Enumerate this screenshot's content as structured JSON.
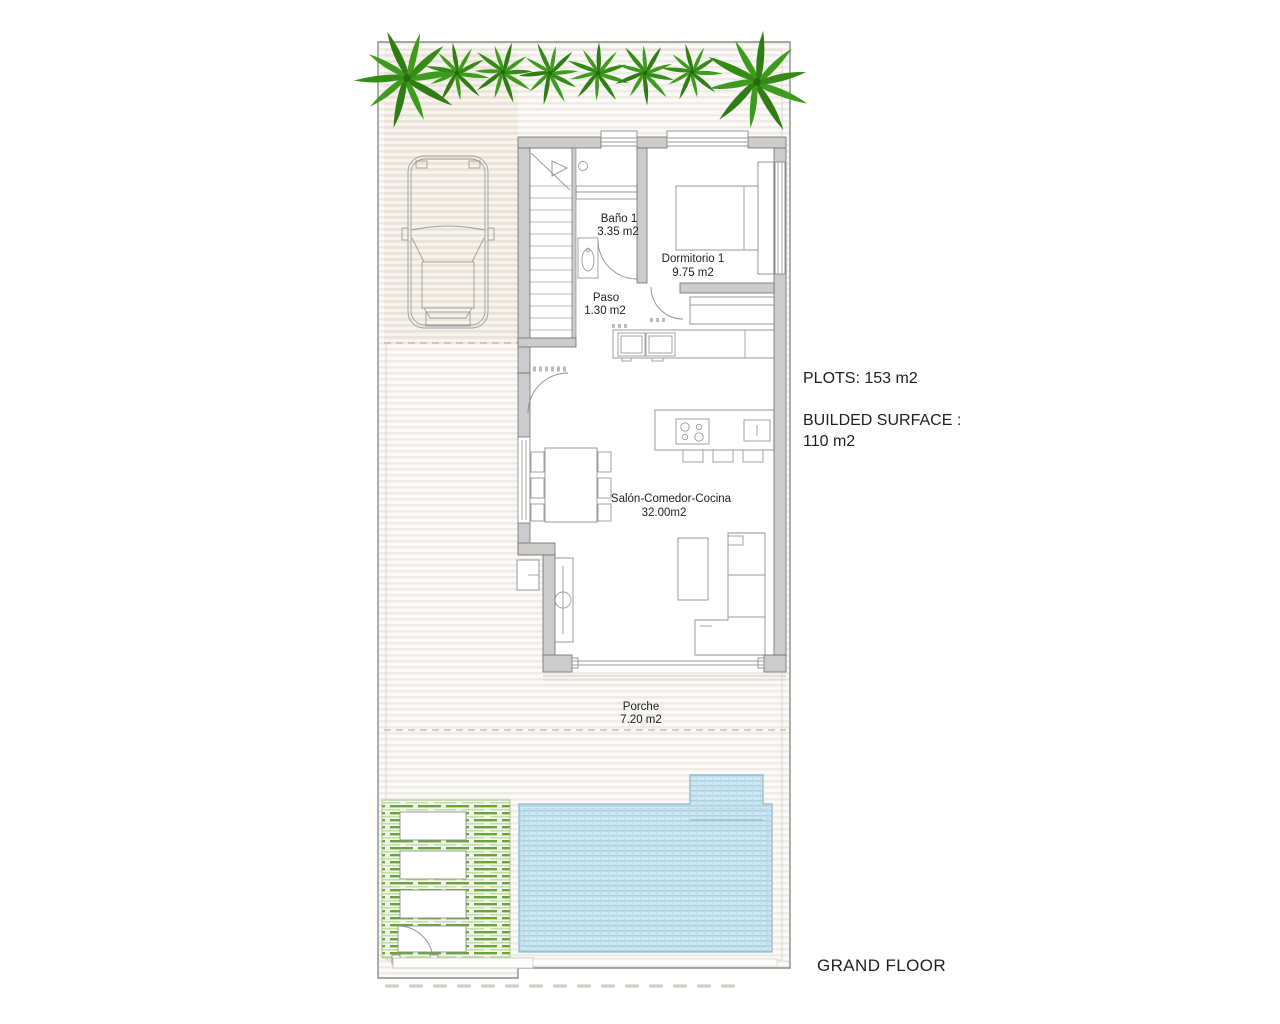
{
  "rooms": [
    {
      "name": "Baño 1",
      "area": "3.35 m2"
    },
    {
      "name": "Dormitorio 1",
      "area": "9.75 m2"
    },
    {
      "name": "Paso",
      "area": "1.30 m2"
    },
    {
      "name": "Salón-Comedor-Cocina",
      "area": "32.00m2"
    },
    {
      "name": "Porche",
      "area": "7.20 m2"
    }
  ],
  "annotations": {
    "plots": "PLOTS: 153 m2",
    "built_surface_line1": "BUILDED SURFACE :",
    "built_surface_line2": "110 m2",
    "floor_title": "GRAND FLOOR"
  },
  "colors": {
    "plant_green": "#3e9b1e",
    "garden_hatch_green": "#6ba23e",
    "pool_blue": "#cfe7f2",
    "pool_stripe": "#abd3e3",
    "wall_gray": "#cccccc",
    "paving_stripe": "#efece6",
    "text": "#1f1f1f"
  }
}
